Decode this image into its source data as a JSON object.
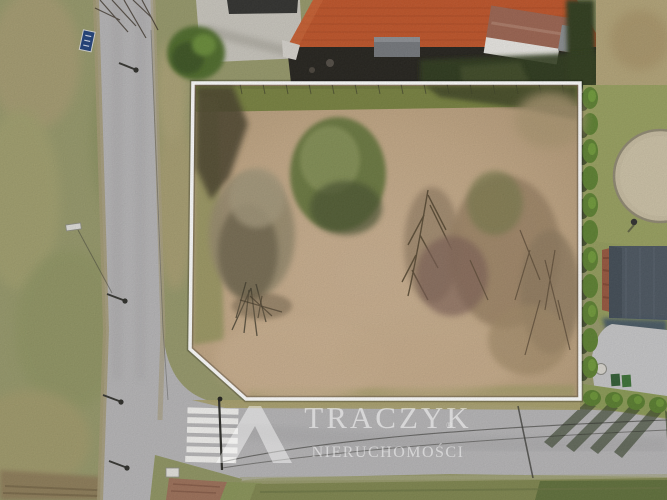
{
  "watermark": {
    "brand": "TRACZYK",
    "subtitle": "NIERUCHOMOŚCI",
    "registered": "®",
    "text_color": "rgba(255,255,255,0.5)",
    "logo": "peak-monogram"
  },
  "scene": {
    "kind": "aerial-drone-photo",
    "subject": "vacant land plot outlined with white boundary at a road junction",
    "plot_outline_color": "#ffffff",
    "palette": {
      "road_asphalt": "#b6b5b7",
      "field_green": "#96986a",
      "plot_dry_grass": "#c2a785",
      "main_house_roof": "#bf5328",
      "neighbor_house_roof": "#4b5560",
      "conifer_green": "#5c8030",
      "neighbor_lawn": "#98a05f",
      "gravel_circle": "#c8bda2",
      "crosswalk_white": "#f5f5f5"
    }
  }
}
